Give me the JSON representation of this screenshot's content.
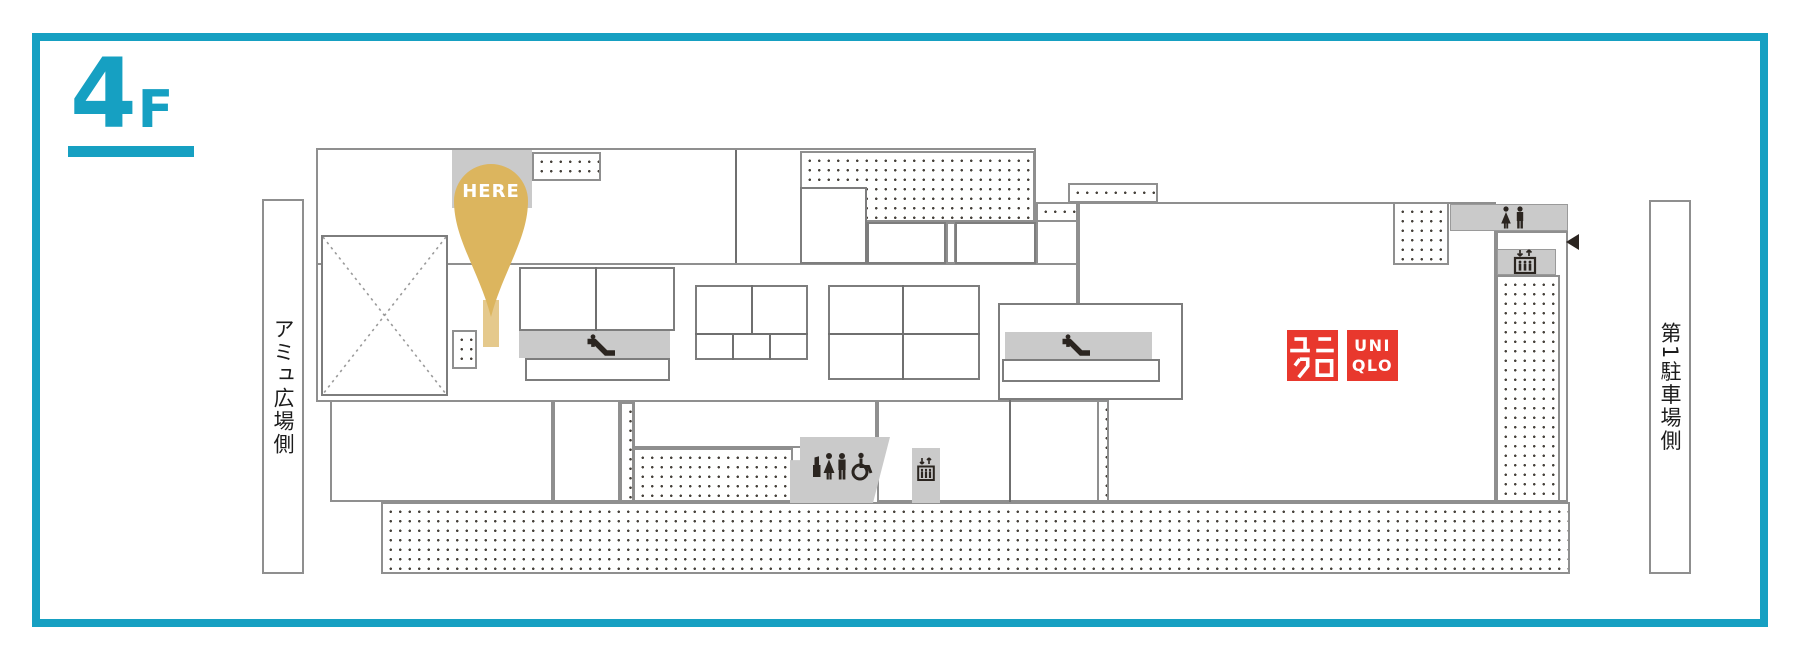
{
  "floor": {
    "number": "4",
    "suffix": "F"
  },
  "marker": {
    "label": "HERE"
  },
  "sides": {
    "left": "アミュ広場側",
    "right": "第1駐車場側"
  },
  "store": {
    "name": "ユニクロ / UNIQLO",
    "logo_jp_line1": "ユニ",
    "logo_jp_line2": "クロ",
    "logo_jp": "ユニクロ",
    "logo_en_line1": "UNI",
    "logo_en_line2": "QLO"
  },
  "icons": {
    "escalator": "escalator-icon",
    "elevator": "elevator-icon",
    "restroom_women": "restroom-women-icon",
    "restroom_men": "restroom-men-icon",
    "powder_room": "powder-room-icon",
    "wheelchair": "wheelchair-accessible-icon",
    "entrance_arrow": "entrance-arrow-icon",
    "crossed_area": "crossed-out-area-icon"
  },
  "colors": {
    "accent_teal": "#16A0C2",
    "pin_gold": "#DCB55E",
    "pin_tail_gold": "#E5C98C",
    "uniqlo_red": "#E8382D",
    "block_gray": "#CACACA",
    "wall_gray": "#8F8F8F",
    "icon_dark": "#2B2520"
  }
}
